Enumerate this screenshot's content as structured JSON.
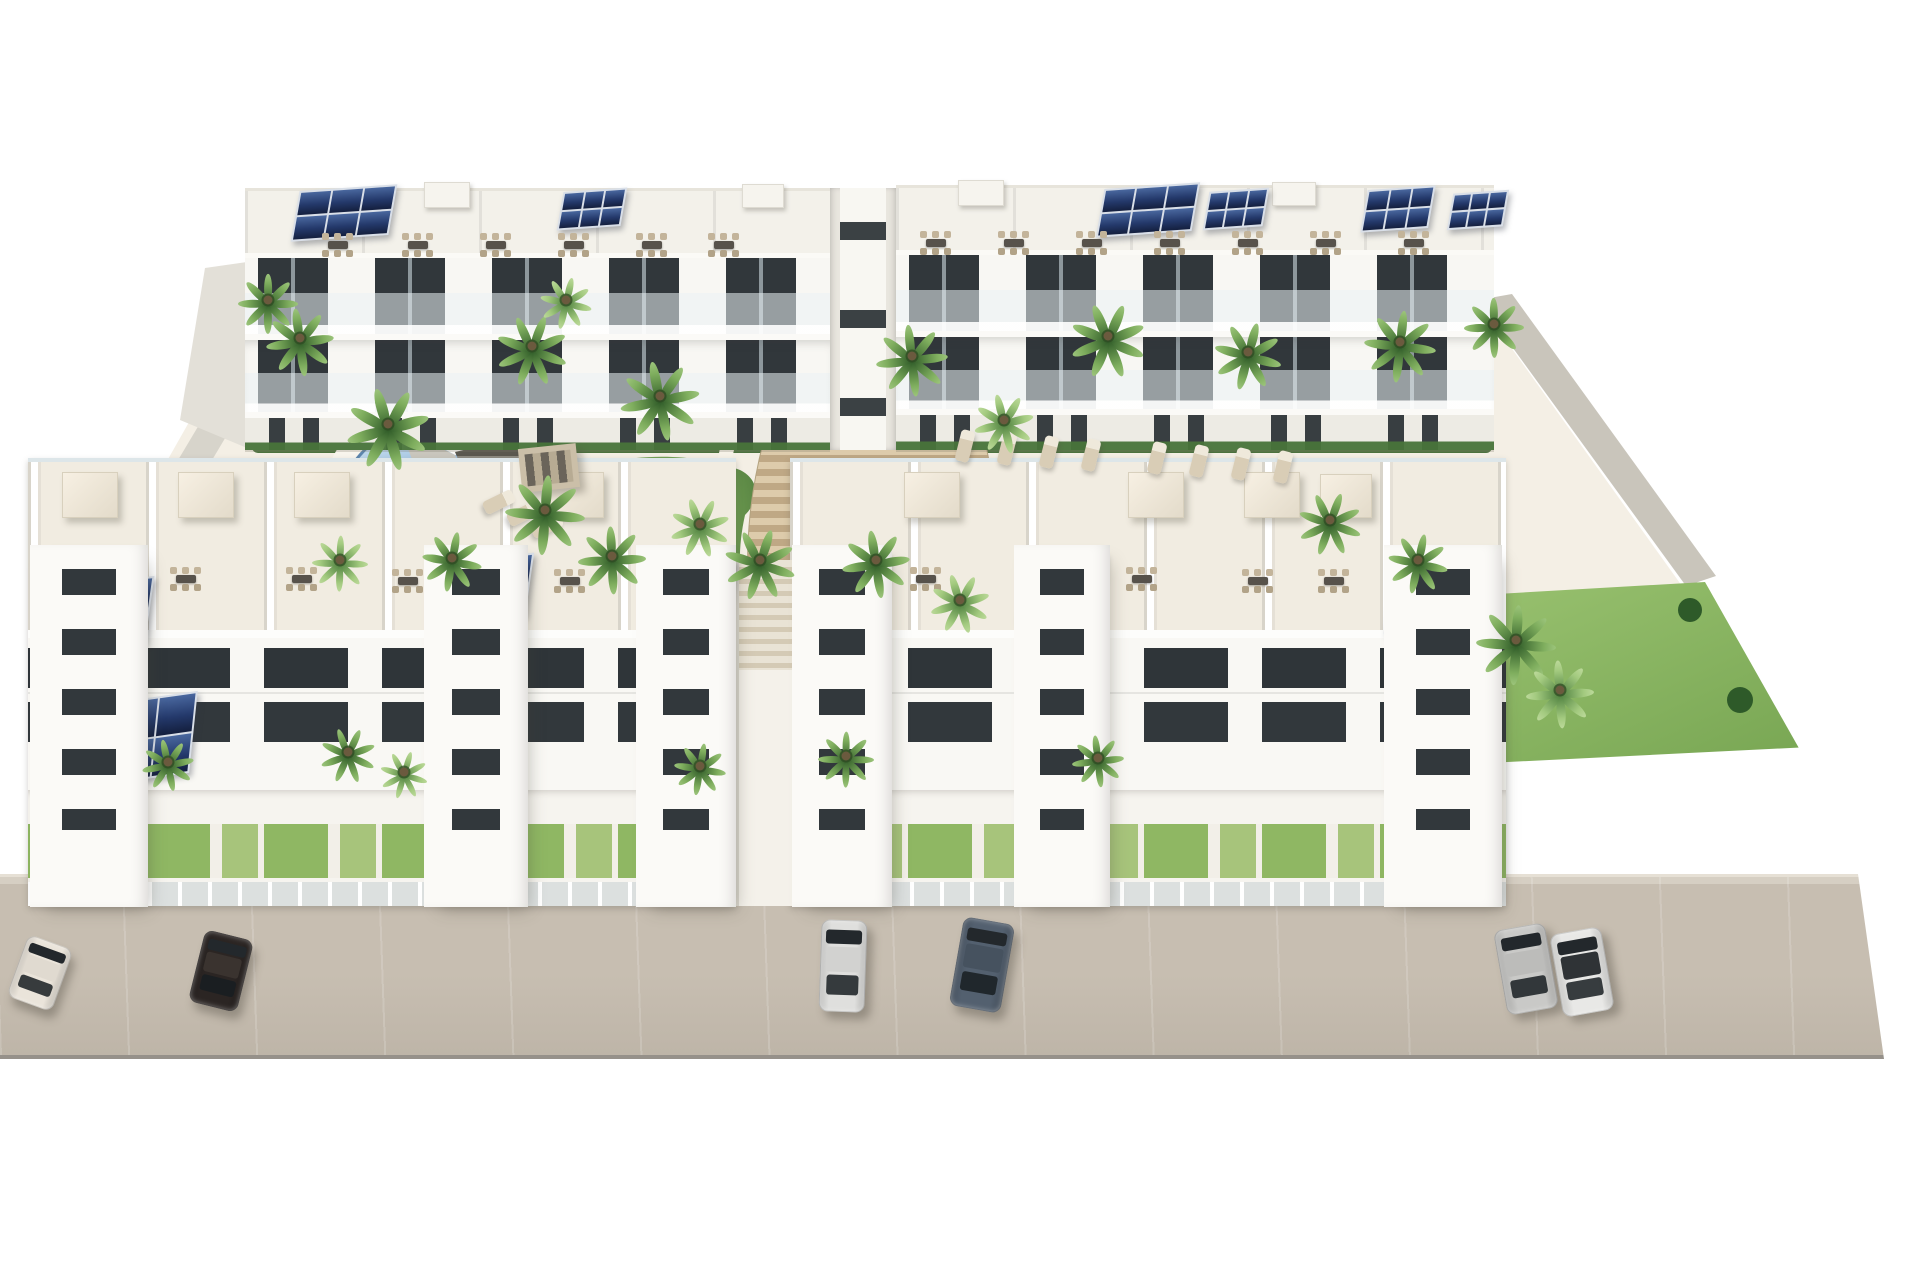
{
  "meta": {
    "description": "Aerial 3D architectural rendering of a white modern residential apartment complex: two rows of low-rise blocks with rooftop terraces and solar panels, landscaped courtyard with palm trees, a freeform pool, a rectangular pool, a wide fan-shaped central staircase, and a beige street in front with six parked cars.",
    "canvas": {
      "w": 1920,
      "h": 1280
    }
  },
  "labels": {
    "scene": "Aerial rendering of white apartment complex with pools and palm trees",
    "back_row": "Rear apartment blocks with balconies and rooftop terraces",
    "front_row": "Front apartment blocks with rooftop terraces facing the courtyard",
    "street": "Front street with parked cars",
    "courtyard": "Landscaped courtyard with pools, gardens and central stairs",
    "left_pool": "Freeform lagoon-style swimming pool",
    "right_pool": "Rectangular swimming pool with sun deck",
    "stairs": "Wide fan-shaped terraced staircase"
  },
  "palette": {
    "background": "#ffffff",
    "building_white": "#f7f6f2",
    "window_dark": "#31373b",
    "terrace_floor": "#f1ece1",
    "street": "#c0b7aa",
    "steps_light": "#dcc9a9",
    "steps_dark": "#c0a987",
    "solar_panel": "#24396b",
    "pool_water_light": "#c9dff0",
    "pool_water_dark": "#51719a",
    "pool_deck_blue": "#a9cde9",
    "garden_green": "#6d9a50",
    "shrub_dark": "#2e5a29",
    "lawn": "#8cb862"
  },
  "scene": {
    "back_row": {
      "blocks": [
        {
          "name": "back-left-block",
          "x": 245,
          "y": 188,
          "w": 585,
          "h": 262
        },
        {
          "name": "back-right-block",
          "x": 896,
          "y": 185,
          "w": 598,
          "h": 265
        }
      ],
      "gap": {
        "x": 830,
        "y": 188,
        "w": 66,
        "h": 262
      }
    },
    "front_row": {
      "blocks": [
        {
          "name": "front-left-block",
          "x": 28,
          "y": 458,
          "w": 708,
          "h": 448
        },
        {
          "name": "front-right-block",
          "x": 790,
          "y": 458,
          "w": 716,
          "h": 448
        }
      ],
      "walkway": {
        "x": 736,
        "y": 560,
        "w": 54,
        "h": 346
      }
    },
    "towers": [
      {
        "x": 30,
        "y": 545,
        "w": 118,
        "h": 362
      },
      {
        "x": 424,
        "y": 545,
        "w": 104,
        "h": 362
      },
      {
        "x": 636,
        "y": 545,
        "w": 100,
        "h": 362
      },
      {
        "x": 792,
        "y": 545,
        "w": 100,
        "h": 362
      },
      {
        "x": 1014,
        "y": 545,
        "w": 96,
        "h": 362
      },
      {
        "x": 1384,
        "y": 545,
        "w": 118,
        "h": 362
      }
    ],
    "roof_boxes": [
      {
        "x": 424,
        "y": 182,
        "w": 44,
        "h": 24
      },
      {
        "x": 742,
        "y": 184,
        "w": 40,
        "h": 22
      },
      {
        "x": 958,
        "y": 180,
        "w": 44,
        "h": 24
      },
      {
        "x": 1272,
        "y": 182,
        "w": 42,
        "h": 22
      }
    ],
    "solar_arrays": [
      {
        "x": 295,
        "y": 188,
        "w": 94,
        "h": 46,
        "rot": -4
      },
      {
        "x": 560,
        "y": 190,
        "w": 60,
        "h": 34,
        "rot": -4
      },
      {
        "x": 1100,
        "y": 186,
        "w": 92,
        "h": 44,
        "rot": -4
      },
      {
        "x": 1206,
        "y": 190,
        "w": 56,
        "h": 34,
        "rot": -4
      },
      {
        "x": 1364,
        "y": 188,
        "w": 64,
        "h": 38,
        "rot": -4
      },
      {
        "x": 1450,
        "y": 192,
        "w": 52,
        "h": 32,
        "rot": -4
      },
      {
        "x": 48,
        "y": 582,
        "w": 98,
        "h": 62,
        "rot": -6
      },
      {
        "x": 440,
        "y": 558,
        "w": 86,
        "h": 58,
        "rot": -6
      },
      {
        "x": 648,
        "y": 564,
        "w": 80,
        "h": 56,
        "rot": -6
      },
      {
        "x": 798,
        "y": 558,
        "w": 84,
        "h": 56,
        "rot": -6
      },
      {
        "x": 1020,
        "y": 558,
        "w": 78,
        "h": 54,
        "rot": -6
      },
      {
        "x": 1388,
        "y": 564,
        "w": 88,
        "h": 60,
        "rot": -6
      },
      {
        "x": 78,
        "y": 700,
        "w": 112,
        "h": 76,
        "rot": -8
      }
    ],
    "dining_sets": [
      {
        "x": 320,
        "y": 232
      },
      {
        "x": 400,
        "y": 232
      },
      {
        "x": 478,
        "y": 232
      },
      {
        "x": 556,
        "y": 232
      },
      {
        "x": 634,
        "y": 232
      },
      {
        "x": 706,
        "y": 232
      },
      {
        "x": 918,
        "y": 230
      },
      {
        "x": 996,
        "y": 230
      },
      {
        "x": 1074,
        "y": 230
      },
      {
        "x": 1152,
        "y": 230
      },
      {
        "x": 1230,
        "y": 230
      },
      {
        "x": 1308,
        "y": 230
      },
      {
        "x": 1396,
        "y": 230
      },
      {
        "x": 168,
        "y": 566
      },
      {
        "x": 284,
        "y": 566
      },
      {
        "x": 390,
        "y": 568
      },
      {
        "x": 552,
        "y": 568
      },
      {
        "x": 908,
        "y": 566
      },
      {
        "x": 1124,
        "y": 566
      },
      {
        "x": 1240,
        "y": 568
      },
      {
        "x": 1316,
        "y": 568
      }
    ],
    "pergolas": [
      {
        "x": 62,
        "y": 472,
        "w": 54,
        "h": 44
      },
      {
        "x": 178,
        "y": 472,
        "w": 54,
        "h": 44
      },
      {
        "x": 294,
        "y": 472,
        "w": 54,
        "h": 44
      },
      {
        "x": 548,
        "y": 472,
        "w": 54,
        "h": 44
      },
      {
        "x": 904,
        "y": 472,
        "w": 54,
        "h": 44
      },
      {
        "x": 1128,
        "y": 472,
        "w": 54,
        "h": 44
      },
      {
        "x": 1244,
        "y": 472,
        "w": 54,
        "h": 44
      },
      {
        "x": 1320,
        "y": 474,
        "w": 50,
        "h": 42
      }
    ],
    "loungers": [
      {
        "x": 958,
        "y": 430,
        "rot": 14
      },
      {
        "x": 1000,
        "y": 433,
        "rot": 14
      },
      {
        "x": 1042,
        "y": 436,
        "rot": 14
      },
      {
        "x": 1084,
        "y": 439,
        "rot": 14
      },
      {
        "x": 1150,
        "y": 442,
        "rot": 14
      },
      {
        "x": 1192,
        "y": 445,
        "rot": 14
      },
      {
        "x": 1234,
        "y": 448,
        "rot": 14
      },
      {
        "x": 1276,
        "y": 451,
        "rot": 14
      },
      {
        "x": 492,
        "y": 486,
        "rot": 64
      },
      {
        "x": 516,
        "y": 498,
        "rot": 64
      },
      {
        "x": 540,
        "y": 510,
        "rot": 64
      }
    ],
    "pavilion": {
      "x": 520,
      "y": 446,
      "w": 58,
      "h": 44,
      "rot": -6
    },
    "palms": [
      {
        "x": 268,
        "y": 300,
        "r": 30
      },
      {
        "x": 300,
        "y": 338,
        "r": 34
      },
      {
        "x": 388,
        "y": 424,
        "r": 42
      },
      {
        "x": 532,
        "y": 346,
        "r": 36
      },
      {
        "x": 566,
        "y": 300,
        "r": 26,
        "light": true
      },
      {
        "x": 545,
        "y": 510,
        "r": 40
      },
      {
        "x": 612,
        "y": 556,
        "r": 34
      },
      {
        "x": 660,
        "y": 396,
        "r": 40
      },
      {
        "x": 700,
        "y": 524,
        "r": 30,
        "light": true
      },
      {
        "x": 760,
        "y": 560,
        "r": 36
      },
      {
        "x": 452,
        "y": 558,
        "r": 30
      },
      {
        "x": 340,
        "y": 560,
        "r": 28,
        "light": true
      },
      {
        "x": 912,
        "y": 356,
        "r": 36
      },
      {
        "x": 1004,
        "y": 420,
        "r": 30,
        "light": true
      },
      {
        "x": 1108,
        "y": 336,
        "r": 38
      },
      {
        "x": 1248,
        "y": 352,
        "r": 34
      },
      {
        "x": 1400,
        "y": 342,
        "r": 36
      },
      {
        "x": 1494,
        "y": 324,
        "r": 30
      },
      {
        "x": 876,
        "y": 560,
        "r": 34
      },
      {
        "x": 960,
        "y": 600,
        "r": 30,
        "light": true
      },
      {
        "x": 1330,
        "y": 520,
        "r": 32
      },
      {
        "x": 1418,
        "y": 560,
        "r": 30
      },
      {
        "x": 1516,
        "y": 640,
        "r": 40
      },
      {
        "x": 1560,
        "y": 690,
        "r": 34,
        "light": true
      },
      {
        "x": 168,
        "y": 762,
        "r": 26
      },
      {
        "x": 348,
        "y": 752,
        "r": 28
      },
      {
        "x": 404,
        "y": 772,
        "r": 24,
        "light": true
      },
      {
        "x": 700,
        "y": 766,
        "r": 26
      },
      {
        "x": 846,
        "y": 756,
        "r": 28
      },
      {
        "x": 1098,
        "y": 758,
        "r": 26
      }
    ],
    "cars": [
      {
        "name": "white-sedan",
        "x": 16,
        "y": 940,
        "w": 48,
        "h": 66,
        "rot": 20,
        "body": "#eae4da",
        "roof": "#e0dad0"
      },
      {
        "name": "dark-sedan",
        "x": 196,
        "y": 934,
        "w": 50,
        "h": 74,
        "rot": 14,
        "body": "#2b2523",
        "roof": "#3a332f"
      },
      {
        "name": "white-hatchback",
        "x": 820,
        "y": 920,
        "w": 46,
        "h": 92,
        "rot": 2,
        "body": "#dfdfdd",
        "roof": "#d2d2d0"
      },
      {
        "name": "gray-blue-car",
        "x": 956,
        "y": 920,
        "w": 52,
        "h": 90,
        "rot": 10,
        "body": "#53606f",
        "roof": "#46525f"
      },
      {
        "name": "silver-suv",
        "x": 1500,
        "y": 926,
        "w": 52,
        "h": 86,
        "rot": -10,
        "body": "#c9c9c7",
        "roof": "#bcbcba"
      },
      {
        "name": "white-coupe",
        "x": 1556,
        "y": 930,
        "w": 52,
        "h": 84,
        "rot": -10,
        "body": "#e8e8e6",
        "roof": "#2f3336"
      }
    ]
  }
}
